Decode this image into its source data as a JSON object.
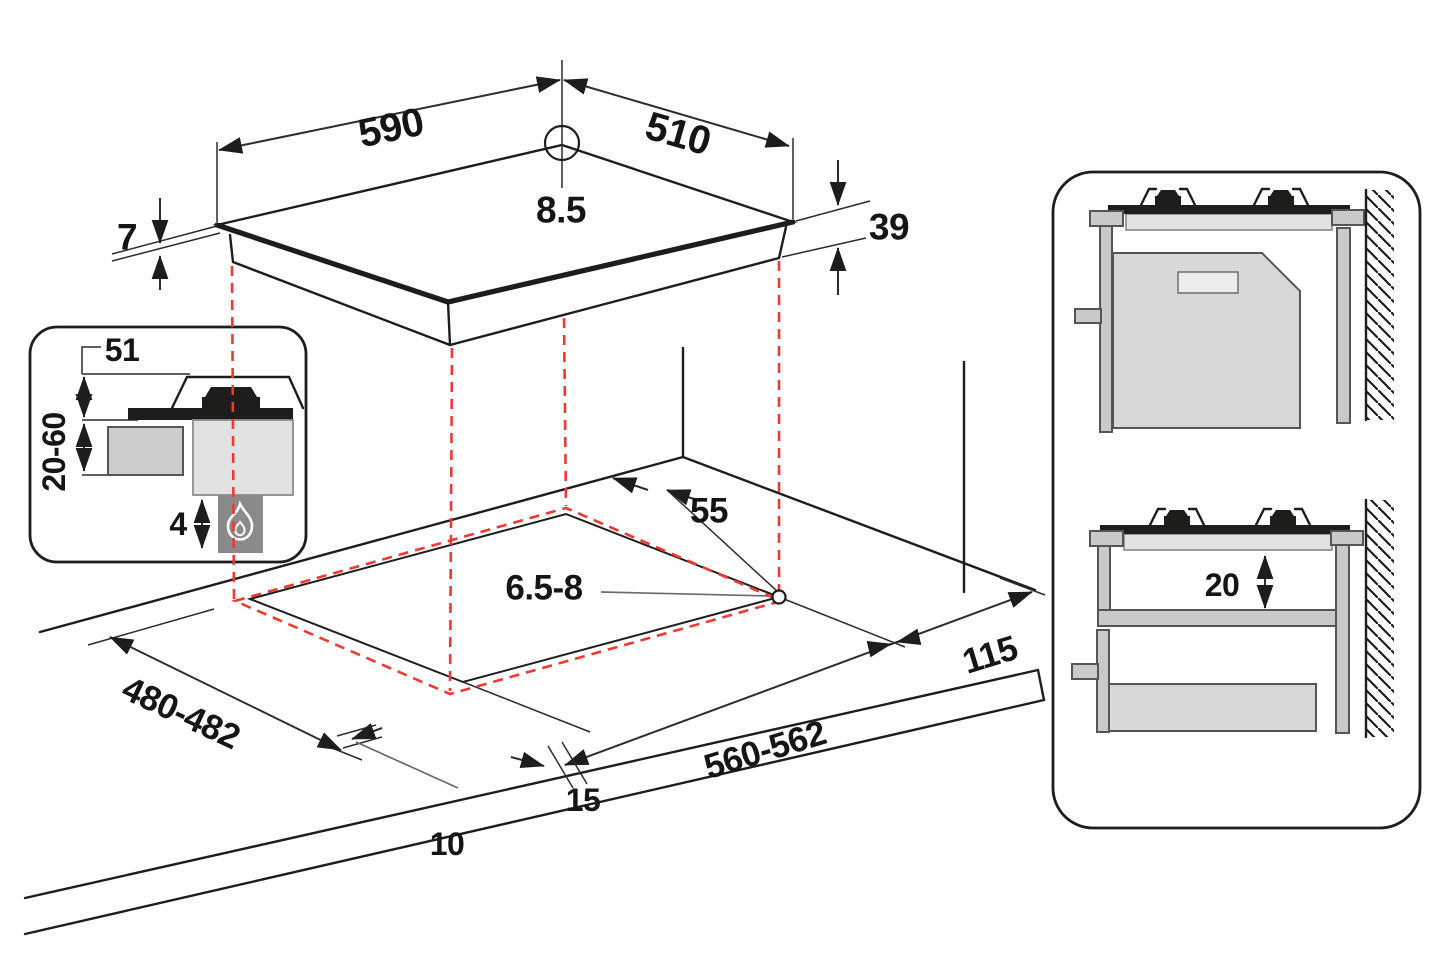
{
  "title": "Gas hob installation dimensions diagram",
  "colors": {
    "line": "#1d1d1b",
    "projection": "#ee3a33",
    "panel_gray": "#d8d8d8",
    "light_gray": "#e2e2e2",
    "mid_gray": "#c9c9c9",
    "dark_gray": "#8a8a8a"
  },
  "hob_top_view": {
    "width": "590",
    "depth": "510",
    "hole_diameter": "8.5",
    "glass_thickness": "7",
    "body_height": "39"
  },
  "burner_detail_inset": {
    "grate_height": "51",
    "clearance_below": "20-60",
    "flame_gap": "4",
    "icon": "flame-icon"
  },
  "worktop_cutout": {
    "back_clearance": "55",
    "hole_diameter": "6.5-8",
    "cutout_depth": "480-482",
    "cutout_width": "560-562",
    "wall_clearance": "115",
    "hob_overhang": "15",
    "front_offset": "10"
  },
  "installation_side_views": {
    "shelf_clearance": "20"
  }
}
